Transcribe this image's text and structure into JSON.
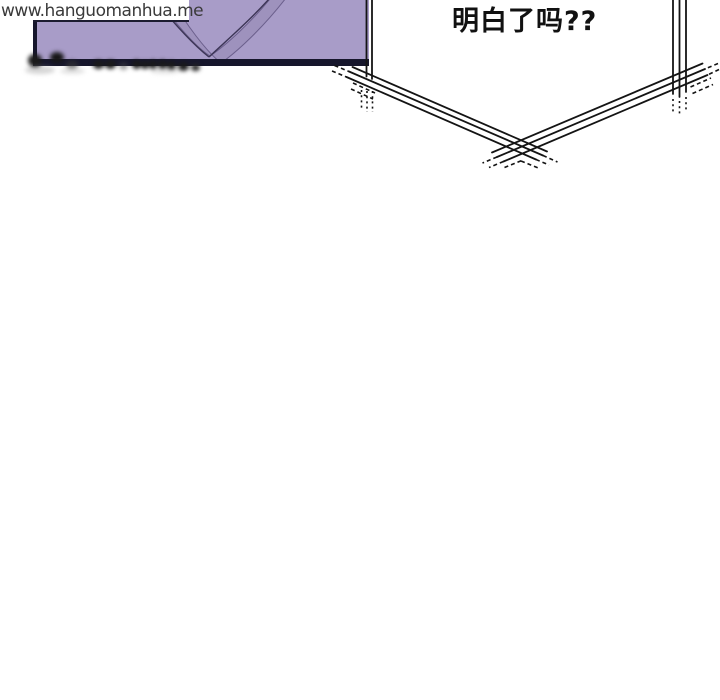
{
  "watermark": {
    "text": "www.hanguomanhua.me",
    "color": "#3a3a3a",
    "background": "#ffffff"
  },
  "panel": {
    "description": "top-left comic panel fragment, cut off by page top",
    "fill_color": "#a89cc8",
    "border_color": "#16162c",
    "drape_fill": "#9e92bd",
    "drape_line_color": "#443d60"
  },
  "censored_caption": {
    "description": "blurred illegible caption smudges along panel bottom edge",
    "color": "#1a1a1a"
  },
  "speech_bubble": {
    "text": "明白了吗??",
    "text_color": "#111111",
    "outline_color": "#141414",
    "style": "angular bubble with sketchy double/triple outline and overshoot dashes"
  }
}
